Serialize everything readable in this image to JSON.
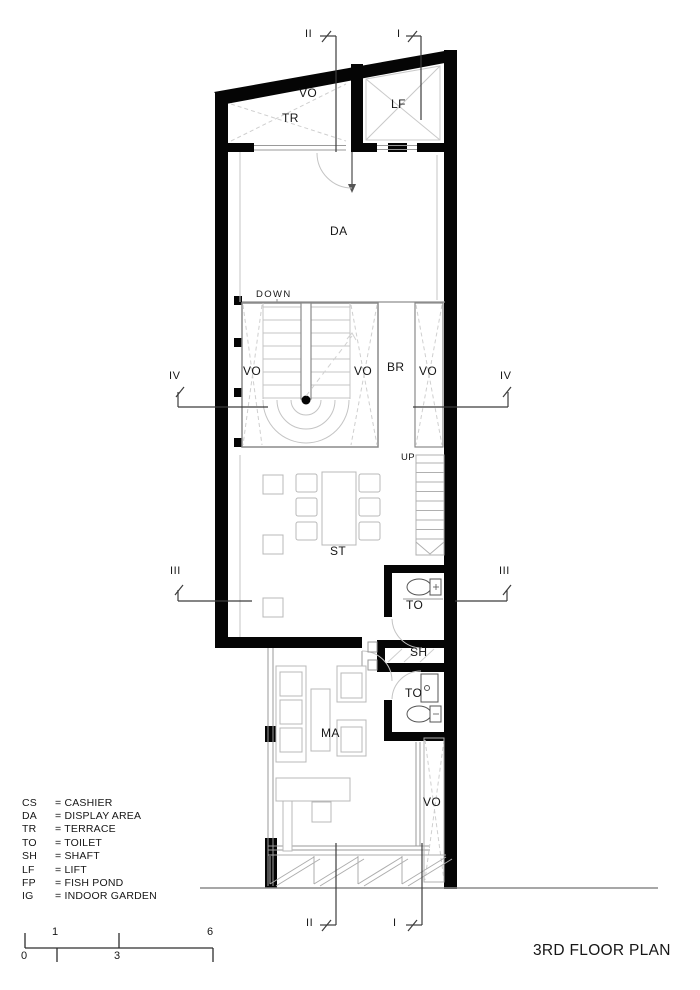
{
  "drawing": {
    "title": "3RD FLOOR PLAN",
    "room_labels": {
      "vo_top": "VO",
      "tr": "TR",
      "lf": "LF",
      "da": "DA",
      "down": "DOWN",
      "vo_stair_left": "VO",
      "vo_stair_right": "VO",
      "br": "BR",
      "vo_mid_right": "VO",
      "up": "UP",
      "st": "ST",
      "to_upper": "TO",
      "sh": "SH",
      "to_lower": "TO",
      "ma": "MA",
      "vo_bottom_right": "VO"
    },
    "section_markers": {
      "top_ii": "II",
      "top_i": "I",
      "left_iv": "IV",
      "right_iv": "IV",
      "left_iii": "III",
      "right_iii": "III",
      "bottom_ii": "II",
      "bottom_i": "I"
    },
    "legend": {
      "items": [
        {
          "code": "CS",
          "label": "= CASHIER"
        },
        {
          "code": "DA",
          "label": "= DISPLAY AREA"
        },
        {
          "code": "TR",
          "label": "= TERRACE"
        },
        {
          "code": "TO",
          "label": "= TOILET"
        },
        {
          "code": "SH",
          "label": "= SHAFT"
        },
        {
          "code": "LF",
          "label": "= LIFT"
        },
        {
          "code": "FP",
          "label": "= FISH POND"
        },
        {
          "code": "IG",
          "label": "= INDOOR GARDEN"
        }
      ]
    },
    "scale_bar": {
      "ticks": [
        "0",
        "1",
        "3",
        "6"
      ]
    },
    "colors": {
      "wall": "#050505",
      "detail": "#bdbdbd",
      "annotation": "#3c3c3c"
    }
  }
}
